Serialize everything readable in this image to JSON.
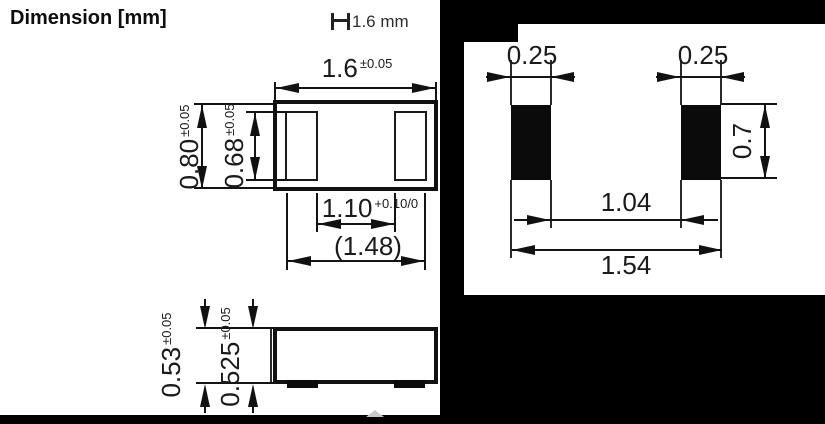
{
  "title": "Dimension [mm]",
  "scale_indicator": {
    "label": "1.6 mm"
  },
  "top_view": {
    "body_width": {
      "value": "1.6",
      "tol": "±0.05"
    },
    "body_height": {
      "value": "0.80",
      "tol": "±0.05"
    },
    "terminal_height": {
      "value": "0.68",
      "tol": "±0.05"
    },
    "terminal_inner_gap": {
      "value": "1.10",
      "tol": "+0.10/0"
    },
    "terminal_outer_span": {
      "value": "(1.48)",
      "tol": ""
    }
  },
  "side_view": {
    "total_height": {
      "value": "0.53",
      "tol": "±0.05"
    },
    "body_height": {
      "value": "0.525",
      "tol": "±0.05"
    }
  },
  "land_pattern": {
    "pad_width_left": {
      "value": "0.25"
    },
    "pad_width_right": {
      "value": "0.25"
    },
    "pad_height": {
      "value": "0.7"
    },
    "pad_gap": {
      "value": "1.04"
    },
    "overall_span": {
      "value": "1.54"
    }
  },
  "colors": {
    "background": "#000000",
    "panel": "#ffffff",
    "ink": "#161616"
  }
}
